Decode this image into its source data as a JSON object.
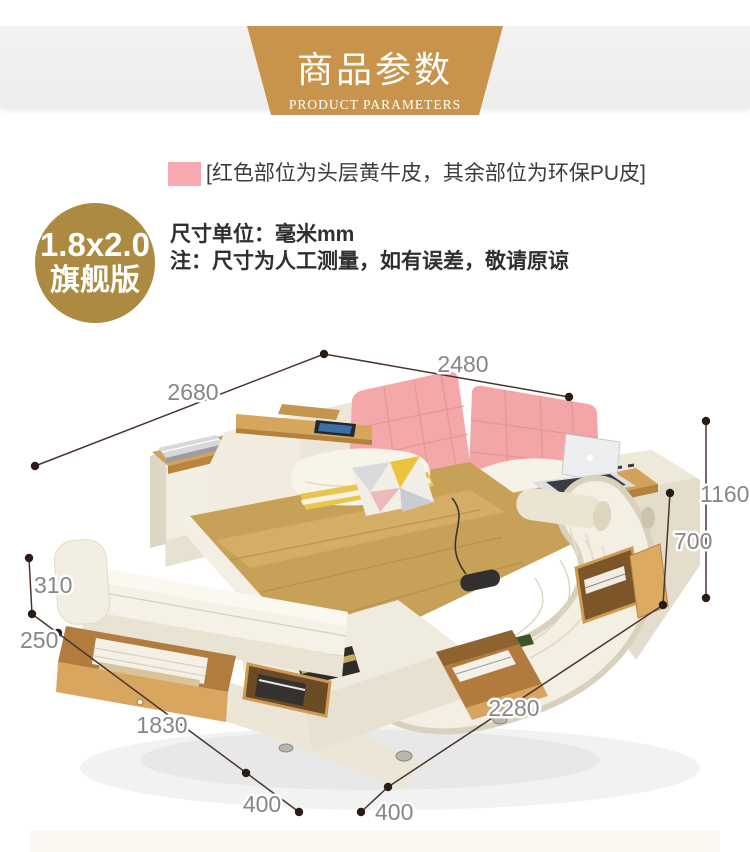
{
  "banner": {
    "title": "商品参数",
    "subtitle": "PRODUCT PARAMETERS",
    "bg_color": "#c8944b"
  },
  "legend": {
    "swatch_color": "#f8a8b0",
    "text": "[红色部位为头层黄牛皮，其余部位为环保PU皮]"
  },
  "badge": {
    "size_label": "1.8x2.0",
    "edition_label": "旗舰版",
    "bg_color": "#ac8a41"
  },
  "notes": {
    "unit_note": "尺寸单位：毫米mm",
    "disclaimer": "注：尺寸为人工测量，如有误差，敬请原谅"
  },
  "diagram": {
    "dims": {
      "top_width": "2480",
      "left_depth": "2680",
      "right_total_height": "1160",
      "right_base_height": "700",
      "left_bench_height": "310",
      "left_drawer_depth": "250",
      "bottom_left_length": "1830",
      "bottom_right_length": "2280",
      "bottom_left_ext": "400",
      "bottom_right_ext": "400"
    },
    "colors": {
      "leather_pink": "#f4a8a9",
      "leather_cream": "#f2eee2",
      "blanket_tan": "#c7a158",
      "wood": "#d2a25b",
      "dim_line": "#4a352e",
      "dim_text": "#868686"
    }
  }
}
